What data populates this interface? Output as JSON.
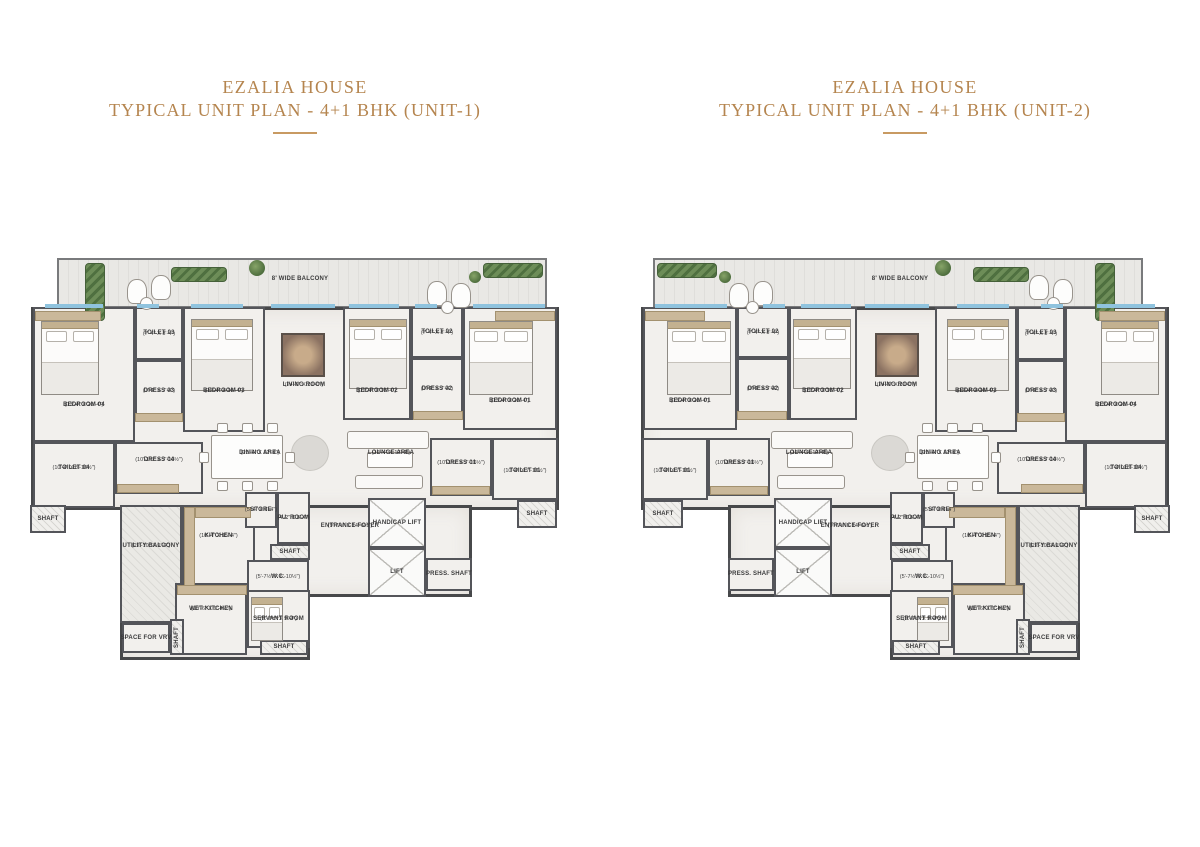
{
  "colors": {
    "title_gold": "#b5854f",
    "wall": "#47484a",
    "floor": "#f2f0ed",
    "glazing": "#8fc3de",
    "greenery": "#4f7040",
    "wood": "#cab89a"
  },
  "plans": [
    {
      "id": "unit-1",
      "title_line1": "EZALIA HOUSE",
      "title_line2": "TYPICAL UNIT PLAN - 4+1 BHK (UNIT-1)",
      "mirrored": false
    },
    {
      "id": "unit-2",
      "title_line1": "EZALIA HOUSE",
      "title_line2": "TYPICAL UNIT PLAN - 4+1 BHK (UNIT-2)",
      "mirrored": true
    }
  ],
  "plan_geometry": {
    "width": 540,
    "height": 405
  },
  "base_shapes": [
    {
      "x": 6,
      "y": 52,
      "w": 528,
      "h": 203
    },
    {
      "x": 95,
      "y": 250,
      "w": 352,
      "h": 92
    },
    {
      "x": 95,
      "y": 335,
      "w": 190,
      "h": 70
    }
  ],
  "balcony": {
    "label": "8' WIDE BALCONY",
    "x": 32,
    "y": 3,
    "w": 490,
    "h": 50,
    "lab": {
      "x": 200,
      "y": 18,
      "w": 150,
      "h": 12
    }
  },
  "rooms": [
    {
      "id": "bedroom-04",
      "name": "BEDROOM 04",
      "dims": "(13'-4\" X 20'-4\")",
      "x": 8,
      "y": 52,
      "w": 102,
      "h": 135,
      "type": "room",
      "lab": {
        "x": 8,
        "y": 142,
        "w": 102,
        "h": 16
      }
    },
    {
      "id": "toilet-03",
      "name": "TOILET 03",
      "dims": "(7'-4\" X 8'-4\")",
      "x": 110,
      "y": 52,
      "w": 48,
      "h": 53,
      "type": "room"
    },
    {
      "id": "dress-03",
      "name": "DRESS 03",
      "dims": "(7'-4\" X 7'-4\")",
      "x": 110,
      "y": 105,
      "w": 48,
      "h": 62,
      "type": "room"
    },
    {
      "id": "bedroom-03",
      "name": "BEDROOM 03",
      "dims": "(12'-4\" X 16'-4\")",
      "x": 158,
      "y": 52,
      "w": 82,
      "h": 125,
      "type": "room",
      "lab": {
        "x": 158,
        "y": 128,
        "w": 82,
        "h": 16
      }
    },
    {
      "id": "living-room",
      "name": "LIVING ROOM",
      "dims": "(24'-0\" X 20'-0\")",
      "x": 240,
      "y": 52,
      "w": 78,
      "h": 125,
      "type": "open",
      "lab": {
        "x": 240,
        "y": 122,
        "w": 78,
        "h": 16
      }
    },
    {
      "id": "bedroom-02",
      "name": "BEDROOM 02",
      "dims": "(12'-4\" X 16'-4\")",
      "x": 318,
      "y": 52,
      "w": 68,
      "h": 113,
      "type": "room",
      "lab": {
        "x": 318,
        "y": 128,
        "w": 68,
        "h": 16
      }
    },
    {
      "id": "toilet-02",
      "name": "TOILET 02",
      "dims": "(7'-4\" X 8'-4\")",
      "x": 386,
      "y": 52,
      "w": 52,
      "h": 51,
      "type": "room"
    },
    {
      "id": "dress-02",
      "name": "DRESS 02",
      "dims": "(7'-4\" X 7'-4\")",
      "x": 386,
      "y": 103,
      "w": 52,
      "h": 62,
      "type": "room"
    },
    {
      "id": "bedroom-01",
      "name": "BEDROOM 01",
      "dims": "(13'-4\" X 20'-4\")",
      "x": 438,
      "y": 52,
      "w": 94,
      "h": 123,
      "type": "room",
      "lab": {
        "x": 438,
        "y": 138,
        "w": 94,
        "h": 16
      }
    },
    {
      "id": "toilet-04",
      "name": "TOILET 04",
      "dims": "(10'-4\" X 8'-10½\")",
      "x": 8,
      "y": 187,
      "w": 82,
      "h": 66,
      "type": "room",
      "lab": {
        "x": 8,
        "y": 205,
        "w": 82,
        "h": 16
      }
    },
    {
      "id": "dress-04",
      "name": "DRESS 04",
      "dims": "(10'-1½\" X 7'-10½\")",
      "x": 90,
      "y": 187,
      "w": 88,
      "h": 52,
      "type": "room",
      "lab": {
        "x": 90,
        "y": 197,
        "w": 88,
        "h": 16
      }
    },
    {
      "id": "dining-area",
      "name": "DINING AREA",
      "dims": "(20'-4\" X 12'-4\")",
      "x": 170,
      "y": 177,
      "w": 110,
      "h": 68,
      "type": "open",
      "lab": {
        "x": 195,
        "y": 190,
        "w": 80,
        "h": 16
      }
    },
    {
      "id": "lounge-area",
      "name": "LOUNGE AREA",
      "dims": "(12'-4\" X 12'-4\")",
      "x": 318,
      "y": 175,
      "w": 96,
      "h": 70,
      "type": "open",
      "lab": {
        "x": 328,
        "y": 190,
        "w": 76,
        "h": 16
      }
    },
    {
      "id": "dress-01",
      "name": "DRESS 01",
      "dims": "(10'-1½\" X 7'-10½\")",
      "x": 405,
      "y": 183,
      "w": 62,
      "h": 58,
      "type": "room",
      "lab": {
        "x": 405,
        "y": 200,
        "w": 62,
        "h": 16
      }
    },
    {
      "id": "toilet-01",
      "name": "TOILET 01",
      "dims": "(10'-4\" X 7'-10½\")",
      "x": 467,
      "y": 183,
      "w": 66,
      "h": 62,
      "type": "room",
      "lab": {
        "x": 467,
        "y": 208,
        "w": 66,
        "h": 16
      }
    },
    {
      "id": "shaft-right",
      "name": "SHAFT",
      "dims": "",
      "x": 492,
      "y": 245,
      "w": 40,
      "h": 28,
      "type": "shaft"
    },
    {
      "id": "shaft-left",
      "name": "SHAFT",
      "dims": "",
      "x": 5,
      "y": 250,
      "w": 36,
      "h": 28,
      "type": "shaft"
    },
    {
      "id": "utility-balcony",
      "name": "UTILITY BALCONY",
      "dims": "(22'-10\" X 9'-4\")",
      "x": 95,
      "y": 250,
      "w": 62,
      "h": 118,
      "type": "utility",
      "lab": {
        "x": 95,
        "y": 280,
        "w": 62,
        "h": 22
      }
    },
    {
      "id": "kitchen",
      "name": "KITCHEN",
      "dims": "(10'-4\" X 15'-4\")",
      "x": 157,
      "y": 250,
      "w": 73,
      "h": 85,
      "type": "room",
      "lab": {
        "x": 160,
        "y": 272,
        "w": 67,
        "h": 18
      }
    },
    {
      "id": "store",
      "name": "STORE",
      "dims": "(5'-4\" X 6'-4\")",
      "x": 220,
      "y": 237,
      "w": 32,
      "h": 36,
      "type": "room"
    },
    {
      "id": "pu-room",
      "name": "PU. ROOM",
      "dims": "(4'-2\" X 6'-4\")",
      "x": 252,
      "y": 237,
      "w": 33,
      "h": 52,
      "type": "room"
    },
    {
      "id": "shaft-mid",
      "name": "SHAFT",
      "dims": "",
      "x": 245,
      "y": 289,
      "w": 40,
      "h": 16,
      "type": "shaft"
    },
    {
      "id": "wc",
      "name": "W.C.",
      "dims": "(5'-7½\" X 6'-10½\")",
      "x": 222,
      "y": 305,
      "w": 62,
      "h": 34,
      "type": "room"
    },
    {
      "id": "entrance-foyer",
      "name": "ENTRANCE FOYER",
      "dims": "(9'-7½\" X 14'-6½\")",
      "x": 285,
      "y": 240,
      "w": 80,
      "h": 100,
      "type": "open",
      "lab": {
        "x": 283,
        "y": 262,
        "w": 84,
        "h": 18
      }
    },
    {
      "id": "handicap-lift",
      "name": "HANDICAP LIFT",
      "dims": "",
      "x": 343,
      "y": 243,
      "w": 58,
      "h": 50,
      "type": "lift"
    },
    {
      "id": "lift",
      "name": "LIFT",
      "dims": "",
      "x": 343,
      "y": 293,
      "w": 58,
      "h": 49,
      "type": "lift"
    },
    {
      "id": "press-shaft",
      "name": "PRESS. SHAFT",
      "dims": "",
      "x": 401,
      "y": 303,
      "w": 46,
      "h": 33,
      "type": "room"
    },
    {
      "id": "wet-kitchen",
      "name": "WET KITCHEN",
      "dims": "(10'-6\" X 9'-4½\")",
      "x": 150,
      "y": 328,
      "w": 72,
      "h": 72,
      "type": "room",
      "lab": {
        "x": 151,
        "y": 345,
        "w": 70,
        "h": 18
      }
    },
    {
      "id": "servant-room",
      "name": "SERVANT ROOM",
      "dims": "(9'-7½\" X 9'-4\")",
      "x": 222,
      "y": 335,
      "w": 63,
      "h": 58,
      "type": "room",
      "lab": {
        "x": 223,
        "y": 355,
        "w": 61,
        "h": 18
      }
    },
    {
      "id": "space-for-vrv",
      "name": "SPACE FOR VRV",
      "dims": "",
      "x": 97,
      "y": 368,
      "w": 48,
      "h": 30,
      "type": "room"
    },
    {
      "id": "shaft-vert",
      "name": "SHAFT",
      "dims": "",
      "x": 145,
      "y": 364,
      "w": 14,
      "h": 36,
      "type": "shaft",
      "rot": true
    },
    {
      "id": "shaft-bottom",
      "name": "SHAFT",
      "dims": "",
      "x": 235,
      "y": 385,
      "w": 48,
      "h": 15,
      "type": "shaft"
    }
  ],
  "decor": [
    {
      "t": "window",
      "x": 20,
      "y": 49,
      "w": 58,
      "h": 4
    },
    {
      "t": "window",
      "x": 112,
      "y": 49,
      "w": 22,
      "h": 4
    },
    {
      "t": "window",
      "x": 166,
      "y": 49,
      "w": 52,
      "h": 4
    },
    {
      "t": "window",
      "x": 246,
      "y": 49,
      "w": 64,
      "h": 4
    },
    {
      "t": "window",
      "x": 324,
      "y": 49,
      "w": 50,
      "h": 4
    },
    {
      "t": "window",
      "x": 390,
      "y": 49,
      "w": 22,
      "h": 4
    },
    {
      "t": "window",
      "x": 448,
      "y": 49,
      "w": 72,
      "h": 4
    },
    {
      "t": "hedge",
      "x": 60,
      "y": 8,
      "w": 20,
      "h": 58
    },
    {
      "t": "hedge",
      "x": 146,
      "y": 12,
      "w": 56,
      "h": 15
    },
    {
      "t": "tree",
      "x": 224,
      "y": 5,
      "w": 16,
      "h": 16
    },
    {
      "t": "hedge",
      "x": 458,
      "y": 8,
      "w": 60,
      "h": 15
    },
    {
      "t": "tree",
      "x": 444,
      "y": 16,
      "w": 12,
      "h": 12
    },
    {
      "t": "chair",
      "x": 102,
      "y": 24,
      "w": 20,
      "h": 25
    },
    {
      "t": "chair",
      "x": 126,
      "y": 20,
      "w": 20,
      "h": 25
    },
    {
      "t": "round",
      "x": 115,
      "y": 42,
      "w": 13,
      "h": 13
    },
    {
      "t": "chair",
      "x": 402,
      "y": 26,
      "w": 20,
      "h": 25
    },
    {
      "t": "chair",
      "x": 426,
      "y": 28,
      "w": 20,
      "h": 25
    },
    {
      "t": "round",
      "x": 416,
      "y": 46,
      "w": 13,
      "h": 13
    },
    {
      "t": "bed",
      "x": 16,
      "y": 66,
      "w": 58,
      "h": 74
    },
    {
      "t": "bed",
      "x": 166,
      "y": 64,
      "w": 62,
      "h": 72
    },
    {
      "t": "bed",
      "x": 324,
      "y": 64,
      "w": 58,
      "h": 70
    },
    {
      "t": "bed",
      "x": 444,
      "y": 66,
      "w": 64,
      "h": 74
    },
    {
      "t": "bed",
      "x": 226,
      "y": 342,
      "w": 32,
      "h": 44
    },
    {
      "t": "tv",
      "x": 256,
      "y": 78,
      "w": 44,
      "h": 44
    },
    {
      "t": "rug",
      "x": 266,
      "y": 180,
      "w": 38,
      "h": 36
    },
    {
      "t": "table",
      "x": 186,
      "y": 180,
      "w": 72,
      "h": 44
    },
    {
      "t": "chairsm",
      "x": 192,
      "y": 168,
      "w": 11,
      "h": 10
    },
    {
      "t": "chairsm",
      "x": 217,
      "y": 168,
      "w": 11,
      "h": 10
    },
    {
      "t": "chairsm",
      "x": 242,
      "y": 168,
      "w": 11,
      "h": 10
    },
    {
      "t": "chairsm",
      "x": 192,
      "y": 226,
      "w": 11,
      "h": 10
    },
    {
      "t": "chairsm",
      "x": 217,
      "y": 226,
      "w": 11,
      "h": 10
    },
    {
      "t": "chairsm",
      "x": 242,
      "y": 226,
      "w": 11,
      "h": 10
    },
    {
      "t": "chairsm",
      "x": 174,
      "y": 197,
      "w": 10,
      "h": 11
    },
    {
      "t": "chairsm",
      "x": 260,
      "y": 197,
      "w": 10,
      "h": 11
    },
    {
      "t": "sofa",
      "x": 322,
      "y": 176,
      "w": 82,
      "h": 18
    },
    {
      "t": "sofa",
      "x": 330,
      "y": 220,
      "w": 68,
      "h": 14
    },
    {
      "t": "coffee",
      "x": 342,
      "y": 197,
      "w": 46,
      "h": 16
    },
    {
      "t": "wood",
      "x": 159,
      "y": 252,
      "w": 11,
      "h": 80
    },
    {
      "t": "wood",
      "x": 170,
      "y": 252,
      "w": 56,
      "h": 11
    },
    {
      "t": "wood",
      "x": 152,
      "y": 330,
      "w": 70,
      "h": 10
    },
    {
      "t": "wood",
      "x": 110,
      "y": 158,
      "w": 48,
      "h": 9
    },
    {
      "t": "wood",
      "x": 388,
      "y": 156,
      "w": 50,
      "h": 9
    },
    {
      "t": "wood",
      "x": 92,
      "y": 229,
      "w": 62,
      "h": 9
    },
    {
      "t": "wood",
      "x": 407,
      "y": 231,
      "w": 58,
      "h": 9
    },
    {
      "t": "wood",
      "x": 470,
      "y": 56,
      "w": 60,
      "h": 10
    },
    {
      "t": "wood",
      "x": 10,
      "y": 56,
      "w": 66,
      "h": 10
    }
  ]
}
